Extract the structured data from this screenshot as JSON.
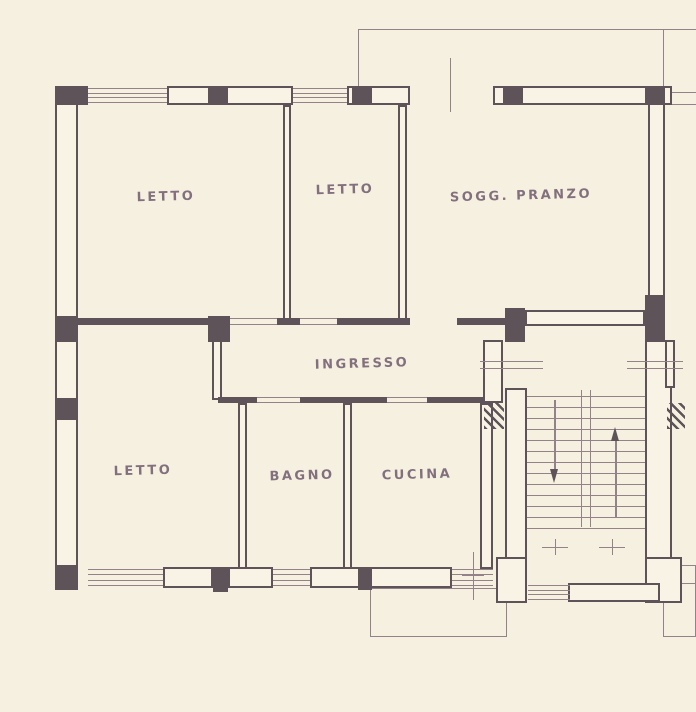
{
  "drawing": {
    "kind": "apartment floor plan",
    "language": "Italian"
  },
  "plan": {
    "colors": {
      "paper": "#f6f0e0",
      "fill": "#f8f3e5",
      "wall": "#5e5359",
      "line": "#948289",
      "text": "#6f5a6d"
    },
    "rooms": [
      "LETTO",
      "LETTO",
      "SOGG. PRANZO",
      "INGRESSO",
      "LETTO",
      "BAGNO",
      "CUCINA"
    ],
    "elements": [
      {
        "t": "line",
        "name": "balcony-top-edge",
        "x": 358,
        "y": 29,
        "w": 338,
        "h": 1
      },
      {
        "t": "line",
        "name": "balcony-top-left-edge",
        "x": 358,
        "y": 29,
        "w": 1,
        "h": 58
      },
      {
        "t": "line",
        "name": "balcony-top-right-edge",
        "x": 663,
        "y": 29,
        "w": 1,
        "h": 58
      },
      {
        "t": "line",
        "name": "construction-line-a",
        "x": 665,
        "y": 92,
        "w": 31,
        "h": 1
      },
      {
        "t": "line",
        "name": "construction-line-b",
        "x": 665,
        "y": 104,
        "w": 31,
        "h": 1
      },
      {
        "t": "line",
        "name": "centerline-balcony-door",
        "x": 450,
        "y": 58,
        "w": 1,
        "h": 54
      },
      {
        "t": "frame",
        "name": "balcony-bottom",
        "x": 370,
        "y": 588,
        "w": 137,
        "h": 49
      },
      {
        "t": "frame",
        "name": "balcony-bottom-right",
        "x": 663,
        "y": 565,
        "w": 33,
        "h": 72
      },
      {
        "t": "line",
        "name": "balcony-bottom-right-line",
        "x": 663,
        "y": 583,
        "w": 33,
        "h": 1
      },
      {
        "t": "hollow",
        "name": "wall-north-a",
        "x": 167,
        "y": 86,
        "w": 126,
        "h": 19
      },
      {
        "t": "hollow",
        "name": "wall-north-b",
        "x": 347,
        "y": 86,
        "w": 63,
        "h": 19
      },
      {
        "t": "hollow",
        "name": "wall-north-c",
        "x": 493,
        "y": 86,
        "w": 179,
        "h": 19
      },
      {
        "t": "hollow",
        "name": "wall-west-exterior",
        "x": 55,
        "y": 86,
        "w": 23,
        "h": 502
      },
      {
        "t": "hollow",
        "name": "wall-east-exterior",
        "x": 648,
        "y": 103,
        "w": 17,
        "h": 215
      },
      {
        "t": "hollow",
        "name": "wall-south-a",
        "x": 163,
        "y": 567,
        "w": 50,
        "h": 21
      },
      {
        "t": "hollow",
        "name": "wall-south-b",
        "x": 228,
        "y": 567,
        "w": 45,
        "h": 21
      },
      {
        "t": "hollow",
        "name": "wall-south-c",
        "x": 310,
        "y": 567,
        "w": 142,
        "h": 21
      },
      {
        "t": "hollow",
        "name": "wall-soggiorno-south",
        "x": 525,
        "y": 310,
        "w": 120,
        "h": 16
      },
      {
        "t": "hollow",
        "name": "wall-stair-left",
        "x": 505,
        "y": 388,
        "w": 22,
        "h": 215
      },
      {
        "t": "hollow",
        "name": "wall-stair-right",
        "x": 645,
        "y": 340,
        "w": 27,
        "h": 263
      },
      {
        "t": "hollow",
        "name": "wall-entry",
        "x": 483,
        "y": 340,
        "w": 20,
        "h": 63
      },
      {
        "t": "hollow",
        "name": "wall-stair-left-base",
        "x": 496,
        "y": 557,
        "w": 31,
        "h": 46
      },
      {
        "t": "hollow",
        "name": "wall-stair-right-base",
        "x": 645,
        "y": 557,
        "w": 37,
        "h": 46
      },
      {
        "t": "hollow",
        "name": "wall-landing-right",
        "x": 665,
        "y": 340,
        "w": 10,
        "h": 48
      },
      {
        "t": "hollow",
        "name": "wall-stair-bottom",
        "x": 568,
        "y": 583,
        "w": 92,
        "h": 19
      },
      {
        "t": "hollow",
        "name": "wall-letto1-letto2",
        "x": 283,
        "y": 105,
        "w": 8,
        "h": 215
      },
      {
        "t": "hollow",
        "name": "wall-letto2-soggiorno",
        "x": 398,
        "y": 105,
        "w": 9,
        "h": 215
      },
      {
        "t": "hollow",
        "name": "wall-letto3-bagno",
        "x": 238,
        "y": 403,
        "w": 9,
        "h": 166
      },
      {
        "t": "hollow",
        "name": "wall-bagno-cucina",
        "x": 343,
        "y": 403,
        "w": 9,
        "h": 166
      },
      {
        "t": "hollow",
        "name": "wall-cucina-east",
        "x": 480,
        "y": 403,
        "w": 13,
        "h": 166
      },
      {
        "t": "hollow",
        "name": "wall-ingresso-west",
        "x": 212,
        "y": 340,
        "w": 10,
        "h": 60
      },
      {
        "t": "solid",
        "name": "column-nw-corner",
        "x": 55,
        "y": 86,
        "w": 33,
        "h": 19
      },
      {
        "t": "solid",
        "name": "pier-north-1",
        "x": 208,
        "y": 88,
        "w": 20,
        "h": 15
      },
      {
        "t": "solid",
        "name": "pier-north-2",
        "x": 352,
        "y": 88,
        "w": 20,
        "h": 15
      },
      {
        "t": "solid",
        "name": "pier-north-3",
        "x": 503,
        "y": 88,
        "w": 20,
        "h": 15
      },
      {
        "t": "solid",
        "name": "pier-north-4",
        "x": 645,
        "y": 88,
        "w": 20,
        "h": 15
      },
      {
        "t": "solid",
        "name": "column-west-mid",
        "x": 55,
        "y": 316,
        "w": 23,
        "h": 26
      },
      {
        "t": "solid",
        "name": "column-west-low",
        "x": 55,
        "y": 398,
        "w": 23,
        "h": 22
      },
      {
        "t": "solid",
        "name": "column-sw-corner",
        "x": 55,
        "y": 565,
        "w": 23,
        "h": 25
      },
      {
        "t": "solid",
        "name": "pier-south-1",
        "x": 213,
        "y": 567,
        "w": 15,
        "h": 25
      },
      {
        "t": "solid",
        "name": "pier-south-2",
        "x": 358,
        "y": 567,
        "w": 14,
        "h": 23
      },
      {
        "t": "solid",
        "name": "wall-mid-a",
        "x": 78,
        "y": 318,
        "w": 130,
        "h": 7
      },
      {
        "t": "solid",
        "name": "column-mid",
        "x": 208,
        "y": 316,
        "w": 22,
        "h": 26
      },
      {
        "t": "solid",
        "name": "wall-mid-b",
        "x": 277,
        "y": 318,
        "w": 23,
        "h": 7
      },
      {
        "t": "solid",
        "name": "wall-mid-c",
        "x": 337,
        "y": 318,
        "w": 73,
        "h": 7
      },
      {
        "t": "solid",
        "name": "wall-mid-d",
        "x": 457,
        "y": 318,
        "w": 48,
        "h": 7
      },
      {
        "t": "solid",
        "name": "column-landing-left",
        "x": 505,
        "y": 308,
        "w": 20,
        "h": 34
      },
      {
        "t": "solid",
        "name": "column-landing-right",
        "x": 645,
        "y": 295,
        "w": 20,
        "h": 47
      },
      {
        "t": "solid",
        "name": "wall-ingresso-south-a",
        "x": 218,
        "y": 397,
        "w": 39,
        "h": 6
      },
      {
        "t": "solid",
        "name": "wall-ingresso-south-b",
        "x": 300,
        "y": 397,
        "w": 87,
        "h": 6
      },
      {
        "t": "solid",
        "name": "wall-ingresso-south-c",
        "x": 427,
        "y": 397,
        "w": 56,
        "h": 6
      },
      {
        "t": "hl",
        "name": "window-letto1",
        "x": 88,
        "y": 88,
        "w": 79,
        "h": 15,
        "n": 4
      },
      {
        "t": "hl",
        "name": "window-letto2",
        "x": 293,
        "y": 88,
        "w": 54,
        "h": 15,
        "n": 4
      },
      {
        "t": "hl",
        "name": "window-letto3",
        "x": 88,
        "y": 569,
        "w": 75,
        "h": 17,
        "n": 4
      },
      {
        "t": "hl",
        "name": "window-bagno",
        "x": 273,
        "y": 569,
        "w": 37,
        "h": 17,
        "n": 4
      },
      {
        "t": "hl",
        "name": "window-cucina",
        "x": 452,
        "y": 569,
        "w": 41,
        "h": 17,
        "n": 4
      },
      {
        "t": "hl",
        "name": "door-letto1",
        "x": 230,
        "y": 318,
        "w": 47,
        "h": 7,
        "n": 2
      },
      {
        "t": "hl",
        "name": "door-letto2",
        "x": 300,
        "y": 318,
        "w": 37,
        "h": 7,
        "n": 2
      },
      {
        "t": "hl",
        "name": "door-bagno",
        "x": 257,
        "y": 397,
        "w": 43,
        "h": 6,
        "n": 2
      },
      {
        "t": "hl",
        "name": "door-cucina",
        "x": 387,
        "y": 397,
        "w": 40,
        "h": 6,
        "n": 2
      },
      {
        "t": "hl",
        "name": "door-landing-left",
        "x": 480,
        "y": 361,
        "w": 63,
        "h": 8,
        "n": 2
      },
      {
        "t": "hl",
        "name": "door-landing-right",
        "x": 627,
        "y": 361,
        "w": 56,
        "h": 8,
        "n": 2
      },
      {
        "t": "hatch",
        "name": "wall-hatch-left",
        "x": 484,
        "y": 403,
        "w": 20,
        "h": 26
      },
      {
        "t": "hatch",
        "name": "wall-hatch-right",
        "x": 667,
        "y": 403,
        "w": 18,
        "h": 26
      },
      {
        "t": "hl",
        "name": "stair-treads",
        "x": 527,
        "y": 396,
        "w": 118,
        "h": 133,
        "n": 13
      },
      {
        "t": "vl",
        "name": "stair-stringer",
        "x": 581,
        "y": 390,
        "w": 10,
        "h": 137,
        "n": 2
      },
      {
        "t": "hl",
        "name": "entry-steps",
        "x": 528,
        "y": 585,
        "w": 42,
        "h": 15,
        "n": 4
      },
      {
        "t": "arrow",
        "name": "stair-arrow-up",
        "dir": "up",
        "x": 615,
        "y": 427,
        "h": 91
      },
      {
        "t": "arrow",
        "name": "stair-arrow-down",
        "dir": "down",
        "x": 554,
        "y": 400,
        "h": 83
      },
      {
        "t": "cross",
        "name": "centerline-mark-1",
        "x": 555,
        "y": 547
      },
      {
        "t": "cross",
        "name": "centerline-mark-2",
        "x": 612,
        "y": 547
      },
      {
        "t": "line",
        "name": "centerline-cucina",
        "x": 473,
        "y": 552,
        "w": 1,
        "h": 48
      },
      {
        "t": "line",
        "name": "centerline-cucina-dash",
        "x": 462,
        "y": 575,
        "w": 22,
        "h": 1
      },
      {
        "t": "label",
        "name": "room-label-letto-1",
        "x": 166,
        "y": 197,
        "text": "LETTO"
      },
      {
        "t": "label",
        "name": "room-label-letto-2",
        "x": 345,
        "y": 190,
        "text": "LETTO"
      },
      {
        "t": "label",
        "name": "room-label-soggiorno-pranzo",
        "x": 521,
        "y": 196,
        "text": "SOGG. PRANZO"
      },
      {
        "t": "label",
        "name": "room-label-ingresso",
        "x": 362,
        "y": 364,
        "text": "INGRESSO"
      },
      {
        "t": "label",
        "name": "room-label-letto-3",
        "x": 143,
        "y": 471,
        "text": "LETTO"
      },
      {
        "t": "label",
        "name": "room-label-bagno",
        "x": 302,
        "y": 476,
        "text": "BAGNO"
      },
      {
        "t": "label",
        "name": "room-label-cucina",
        "x": 417,
        "y": 475,
        "text": "CUCINA"
      }
    ]
  }
}
